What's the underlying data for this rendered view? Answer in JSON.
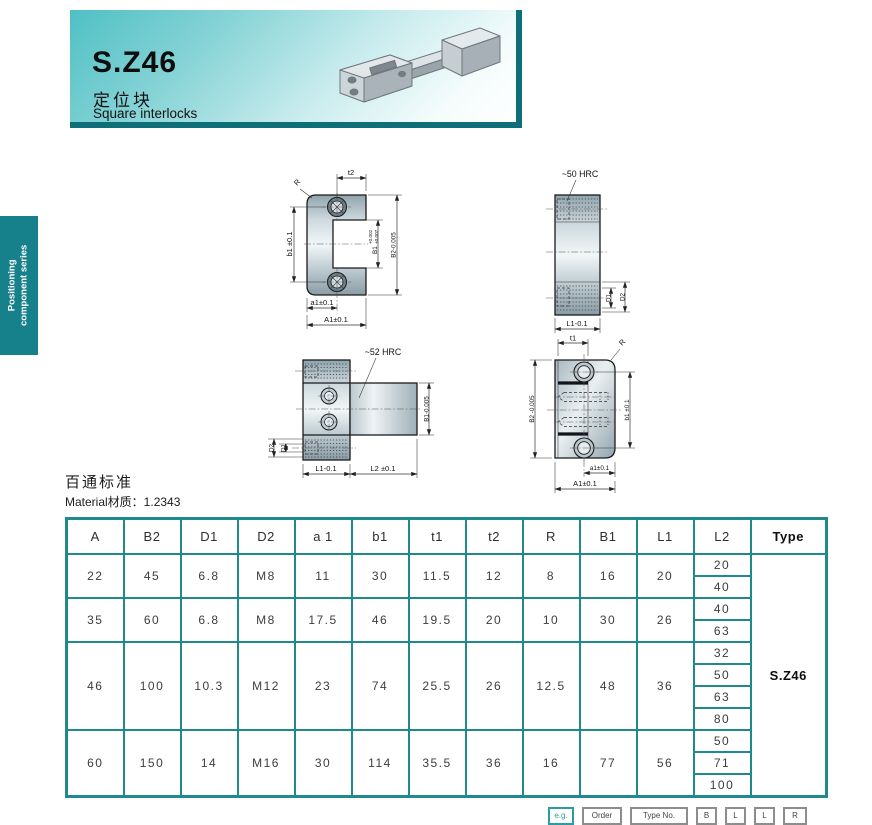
{
  "header": {
    "part_no": "S.Z46",
    "name_cn": "定位块",
    "name_en": "Square interlocks"
  },
  "side_tab": {
    "line1": "Positioning",
    "line2": "component series"
  },
  "standard": {
    "title": "百通标准",
    "material": "Material材质：1.2343"
  },
  "drawings": {
    "front_female": {
      "r": "R",
      "t2": "t2",
      "b1": "b1 ±0.1",
      "b1_inner": "B1",
      "b1_tol_up": "+0.002",
      "b1_tol_dn": "+0.007",
      "b2": "B2-0.005",
      "a1": "a1±0.1",
      "a1_cap": "A1±0.1"
    },
    "side_female": {
      "hrc": "~50 HRC",
      "d1": "D1",
      "d2": "D2",
      "l1": "L1-0.1"
    },
    "side_male": {
      "hrc": "~52 HRC",
      "b1": "B1-0.005",
      "d1": "D1",
      "d2": "D2",
      "l1": "L1-0.1",
      "l2": "L2 ±0.1"
    },
    "front_male": {
      "t1": "t1",
      "r": "R",
      "b2": "B2 -0.005",
      "b1": "b1 ±0.1",
      "a1": "a1±0.1",
      "a1_cap": "A1±0.1"
    }
  },
  "table": {
    "headers": [
      "A",
      "B2",
      "D1",
      "D2",
      "a 1",
      "b1",
      "t1",
      "t2",
      "R",
      "B1",
      "L1",
      "L2",
      "Type"
    ],
    "type_value": "S.Z46",
    "rows": [
      {
        "A": "22",
        "B2": "45",
        "D1": "6.8",
        "D2": "M8",
        "a1": "11",
        "b1": "30",
        "t1": "11.5",
        "t2": "12",
        "R": "8",
        "B1": "16",
        "L1": "20",
        "L2": [
          "20",
          "40"
        ]
      },
      {
        "A": "35",
        "B2": "60",
        "D1": "6.8",
        "D2": "M8",
        "a1": "17.5",
        "b1": "46",
        "t1": "19.5",
        "t2": "20",
        "R": "10",
        "B1": "30",
        "L1": "26",
        "L2": [
          "40",
          "63"
        ]
      },
      {
        "A": "46",
        "B2": "100",
        "D1": "10.3",
        "D2": "M12",
        "a1": "23",
        "b1": "74",
        "t1": "25.5",
        "t2": "26",
        "R": "12.5",
        "B1": "48",
        "L1": "36",
        "L2": [
          "32",
          "50",
          "63",
          "80"
        ]
      },
      {
        "A": "60",
        "B2": "150",
        "D1": "14",
        "D2": "M16",
        "a1": "30",
        "b1": "114",
        "t1": "35.5",
        "t2": "36",
        "R": "16",
        "B1": "77",
        "L1": "56",
        "L2": [
          "50",
          "71",
          "100"
        ]
      }
    ]
  },
  "footer": {
    "boxes": [
      {
        "label": "e.g."
      },
      {
        "label": "Order"
      },
      {
        "label": "Type No."
      },
      {
        "label": "B"
      },
      {
        "label": "L"
      },
      {
        "label": "L"
      },
      {
        "label": "R"
      }
    ]
  },
  "colors": {
    "accent": "#1e8a8c",
    "banner_edge": "#0e6f79",
    "tab": "#16808b"
  }
}
